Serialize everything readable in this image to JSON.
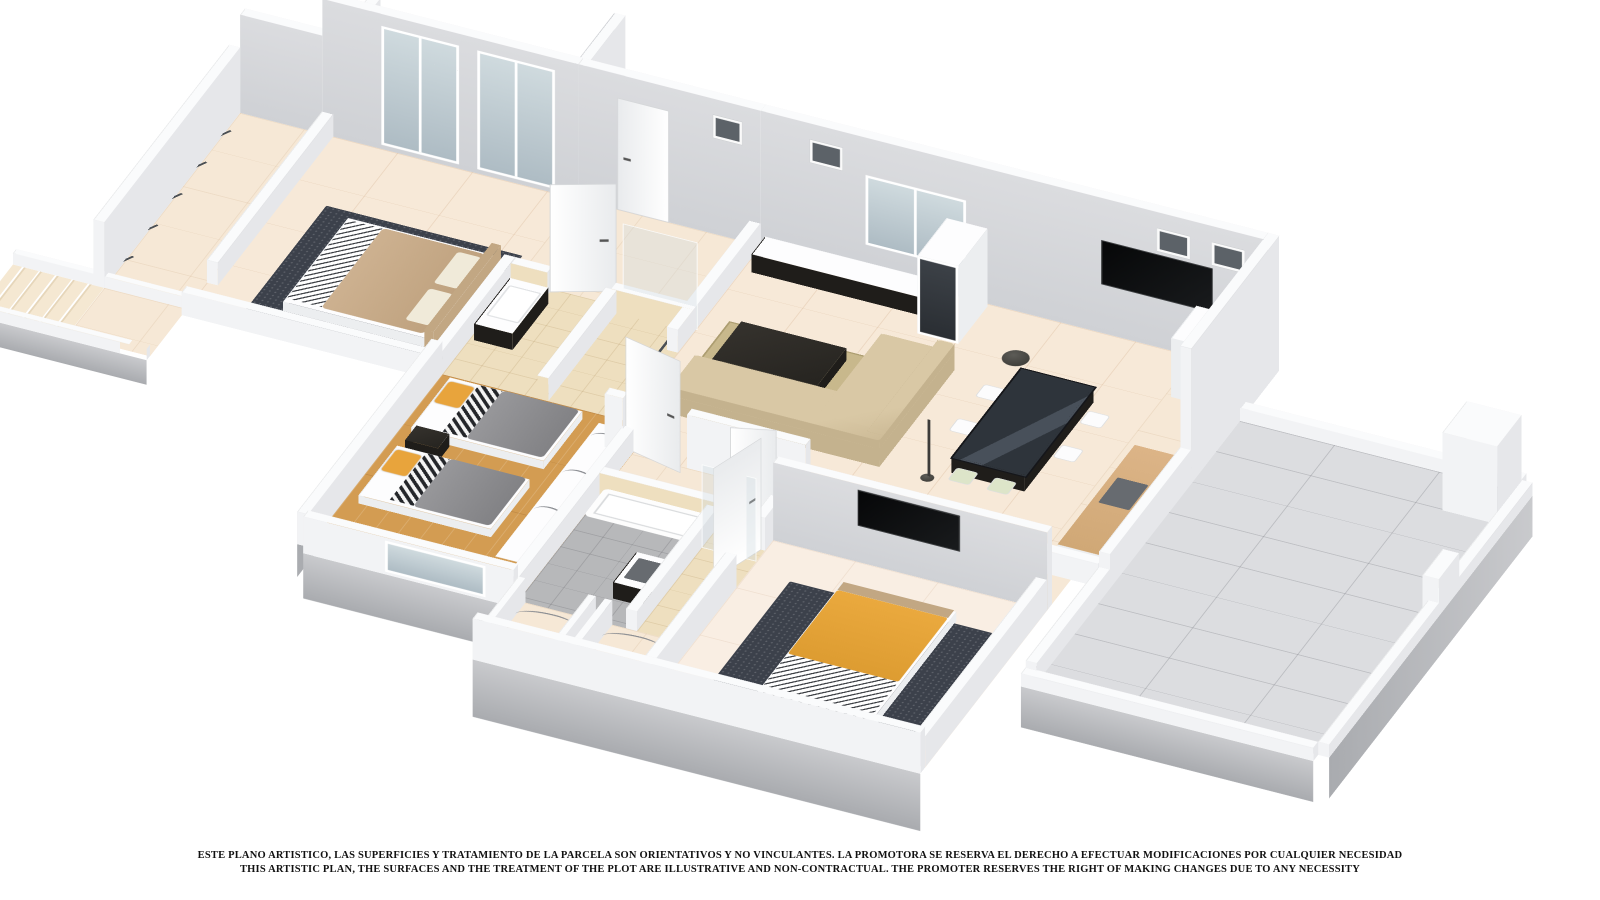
{
  "meta": {
    "type": "3D isometric cutaway floor-plan render",
    "background": "#ffffff"
  },
  "disclaimer": {
    "line1": "ESTE PLANO ARTISTICO, LAS SUPERFICIES Y TRATAMIENTO DE LA PARCELA SON ORIENTATIVOS Y NO VINCULANTES. LA PROMOTORA SE RESERVA EL DERECHO A EFECTUAR MODIFICACIONES POR CUALQUIER NECESIDAD",
    "line2": "THIS ARTISTIC PLAN, THE SURFACES AND THE TREATMENT OF THE PLOT ARE ILLUSTRATIVE AND NON-CONTRACTUAL. THE PROMOTER RESERVES THE RIGHT OF MAKING CHANGES DUE TO ANY NECESSITY"
  },
  "palette": {
    "wall_top": "#fafbfc",
    "wf_s": "#f2f3f5",
    "wf_e": "#e6e7ea",
    "wf_w": "#ebeced",
    "wall_inner_a": "#cfd1d5",
    "wall_inner_b": "#dbdcdf",
    "floor_cream": "#f6e8d6",
    "floor_cream2": "#f7e9d8",
    "floor_pale": "#f9eee3",
    "patio_tile": "#f5e7cf",
    "floor_wood": "#d39c52",
    "floor_terrace": "#dcdde0",
    "bath_tile": "#eedfbf",
    "rug_dark": "#3c414b",
    "rug_living": "#c8b88c",
    "sofa": "#d9c8a5",
    "accent_orange": "#e8a43c",
    "duvet_gray": "#8d8d8f",
    "furniture_dark": "#2b2a27",
    "glass": "#c3ced4"
  }
}
